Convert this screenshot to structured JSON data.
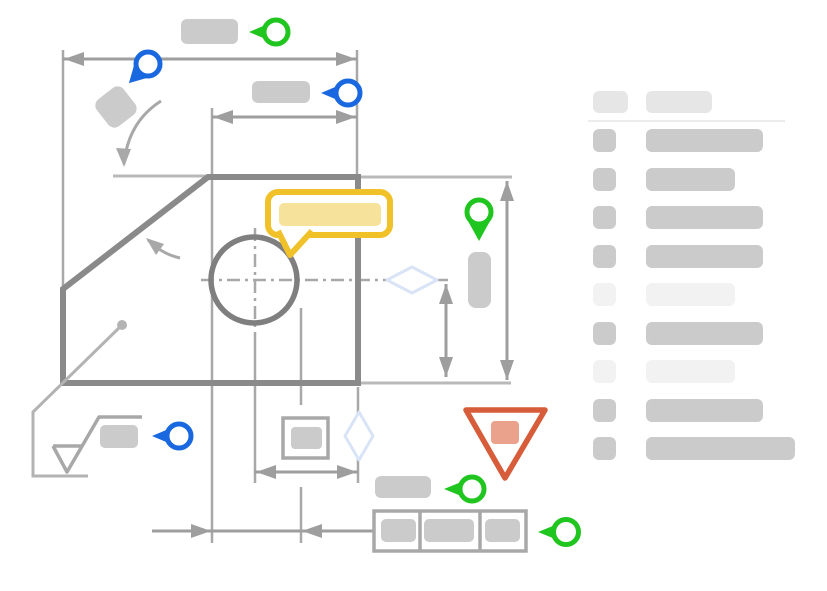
{
  "app": {
    "description": "Engineering-drawing annotation review mockup: dimensioned part view with review pins, comment bubble, warning flag and an annotation list panel"
  },
  "colors": {
    "green": "#20c520",
    "blue": "#1a68e0",
    "yellow": "#f0c128",
    "yellow_light": "#f6e29b",
    "red": "#d65c3a",
    "red_light": "#eba28c",
    "diamond": "#d9e4f7",
    "part": "#8a8a8a",
    "circle": "#7f7f7f",
    "dim": "#9e9e9e",
    "thin": "#a8a8a8",
    "light_line": "#b9b9b9",
    "leader": "#b3b3b3",
    "block": "#cbcbcb",
    "box": "#a8a8a8",
    "header": "#e6e6e6",
    "separator": "#ececec",
    "sidebar_dark": "#cbcbcb",
    "sidebar_light": "#f2f2f2"
  },
  "drawing": {
    "annotations": {
      "pins": [
        {
          "name": "pin-top-width",
          "color": "green",
          "direction": "left"
        },
        {
          "name": "pin-upper-left-angle",
          "color": "blue",
          "direction": "down-left"
        },
        {
          "name": "pin-inner-width",
          "color": "blue",
          "direction": "left"
        },
        {
          "name": "pin-right-height",
          "color": "green",
          "direction": "down"
        },
        {
          "name": "pin-surface-finish",
          "color": "blue",
          "direction": "left"
        },
        {
          "name": "pin-lower-label",
          "color": "green",
          "direction": "left"
        },
        {
          "name": "pin-feature-frame",
          "color": "green",
          "direction": "left"
        }
      ],
      "comment_bubble": {
        "type": "comment",
        "state": "highlighted"
      },
      "warning_triangle": {
        "type": "warning",
        "state": "flagged"
      },
      "diamond_highlights": 2
    },
    "placeholder_labels": 10
  },
  "sidebar": {
    "header": {
      "blocks": [
        {
          "w": 35
        },
        {
          "w": 66
        }
      ]
    },
    "rows": [
      {
        "tone": "dark",
        "bar_w": 117
      },
      {
        "tone": "dark",
        "bar_w": 89
      },
      {
        "tone": "dark",
        "bar_w": 117
      },
      {
        "tone": "dark",
        "bar_w": 117
      },
      {
        "tone": "light",
        "bar_w": 89
      },
      {
        "tone": "dark",
        "bar_w": 117
      },
      {
        "tone": "light",
        "bar_w": 89
      },
      {
        "tone": "dark",
        "bar_w": 117
      },
      {
        "tone": "dark",
        "bar_w": 149
      }
    ]
  }
}
